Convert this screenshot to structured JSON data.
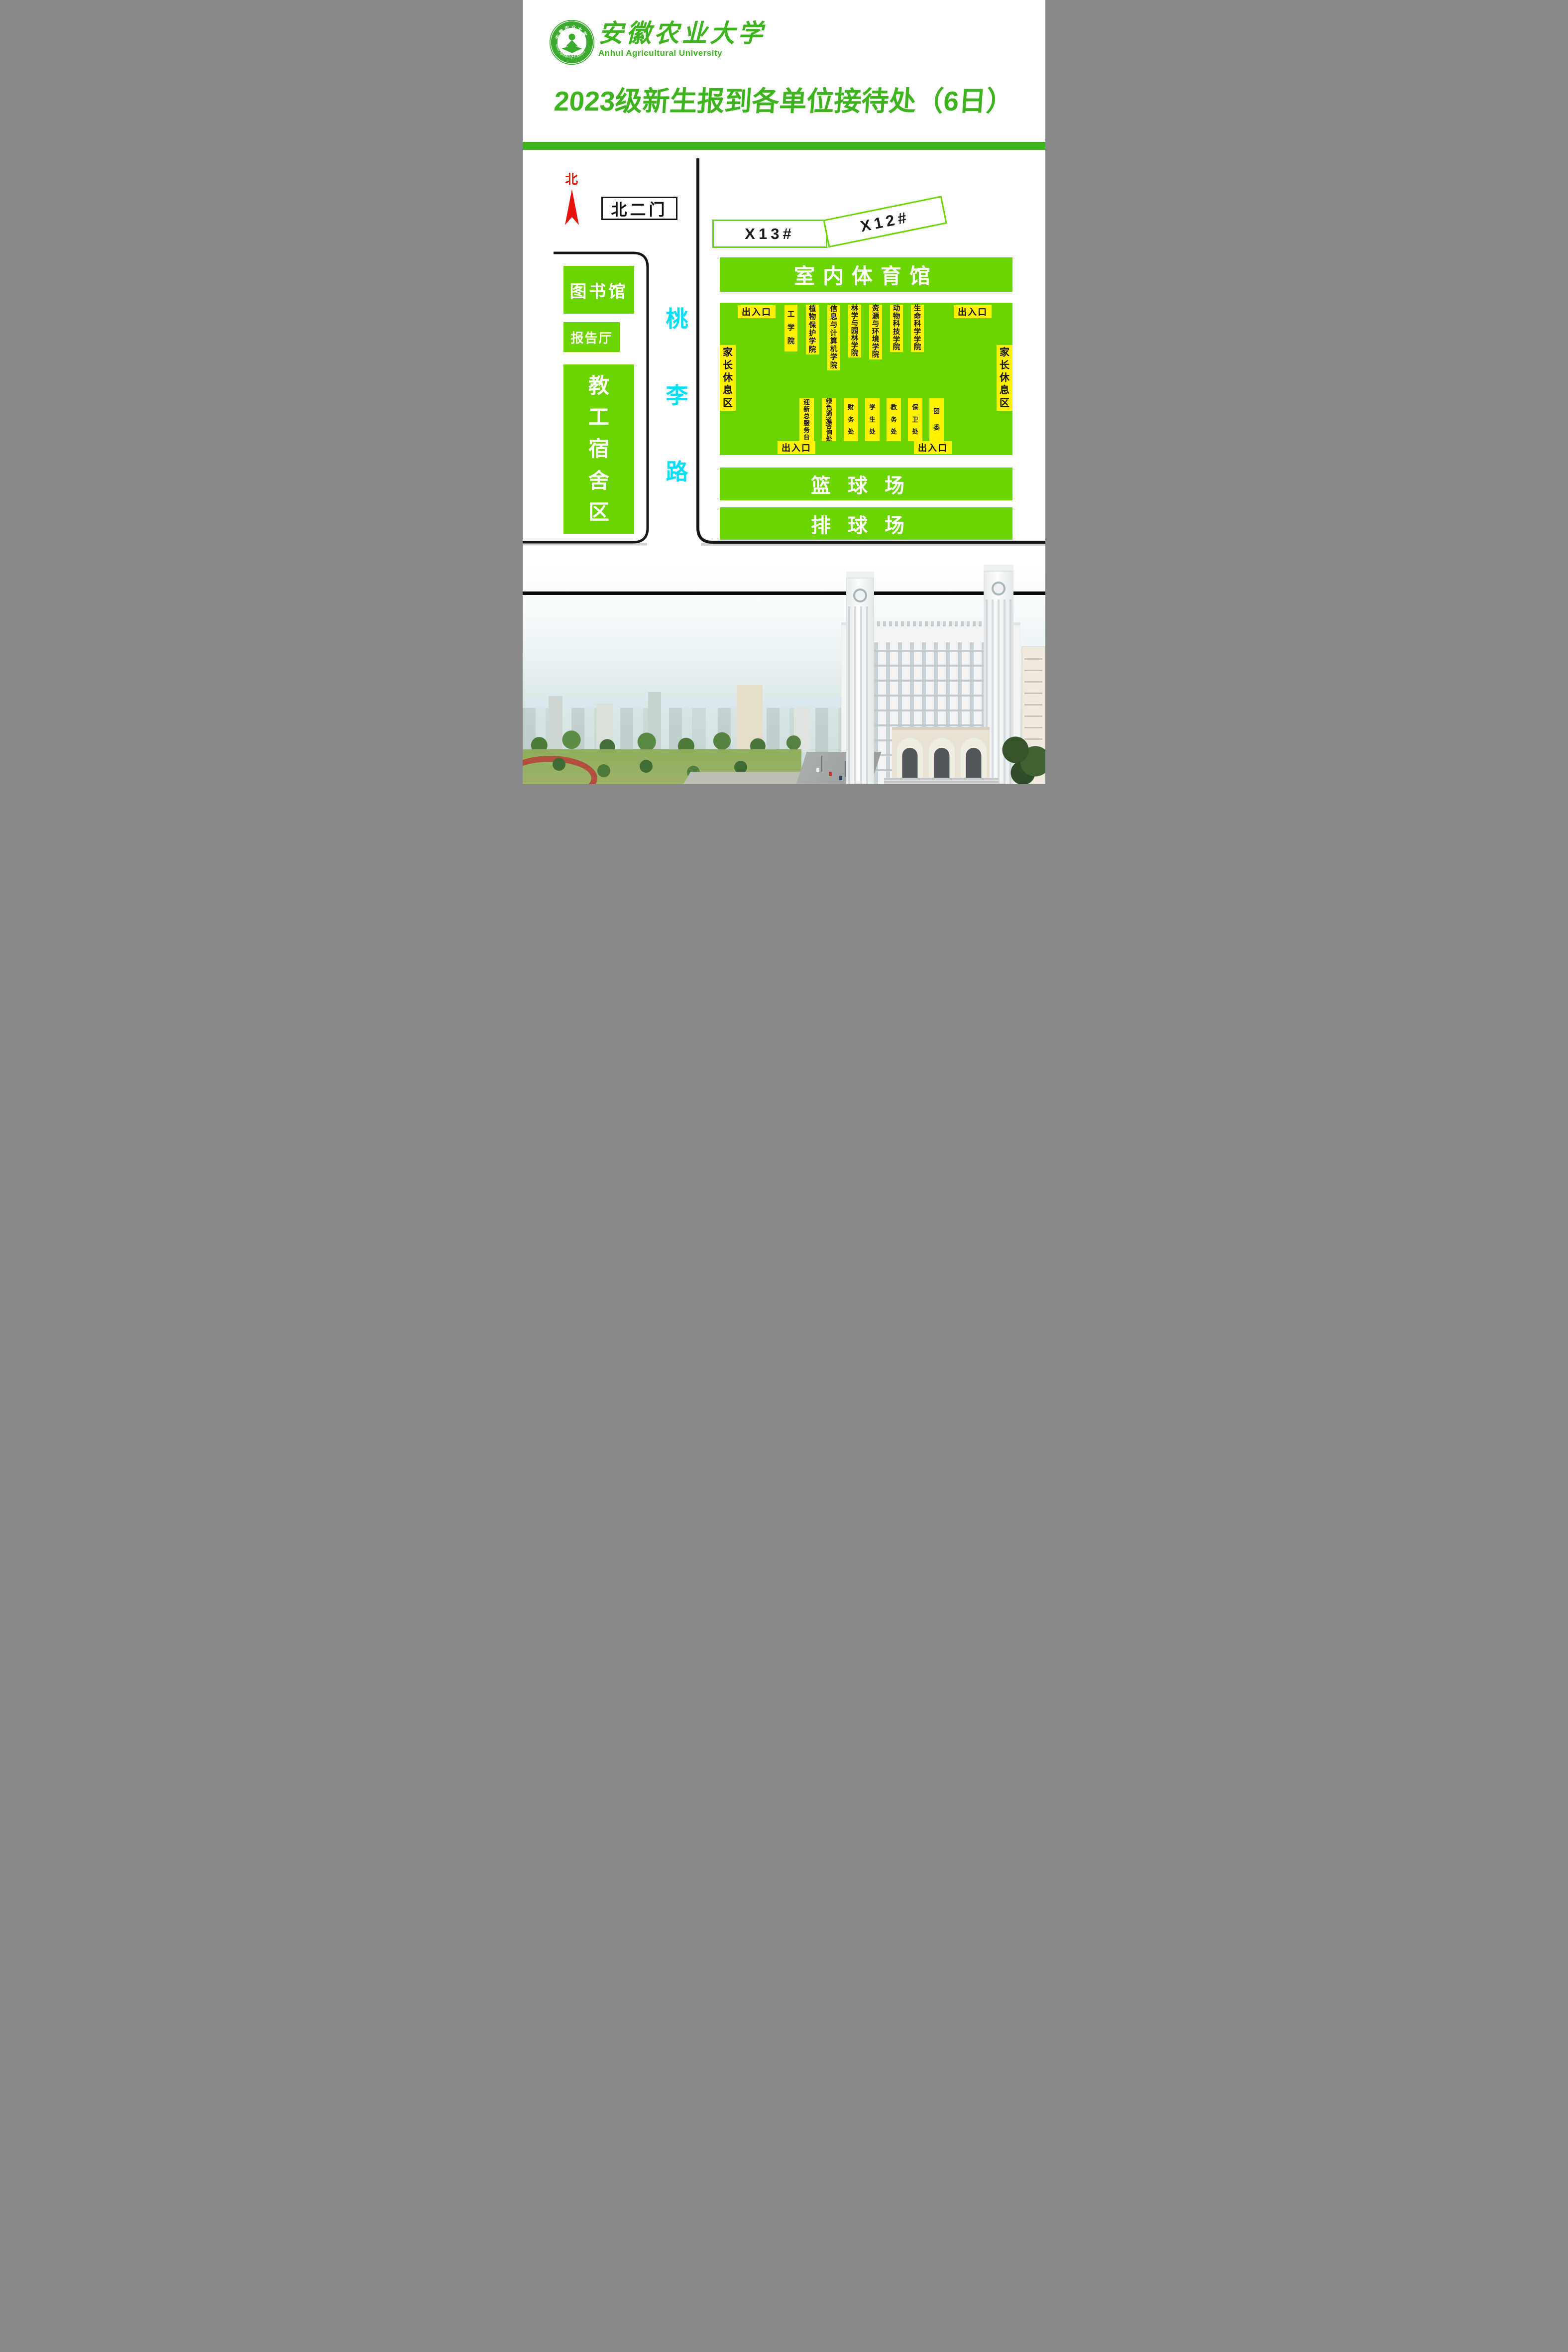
{
  "header": {
    "university_cn": "安徽农业大学",
    "university_en": "Anhui Agricultural University",
    "seal_year": "1928",
    "title": "2023级新生报到各单位接待处（6日）"
  },
  "compass": {
    "north_label": "北"
  },
  "map": {
    "gate_label": "北二门",
    "road_label": "桃李路",
    "library": "图书馆",
    "lecture_hall": "报告厅",
    "staff_dorm": "教工宿舍区",
    "dorm_x13": "X13#",
    "dorm_x12": "X12#",
    "gym": "室内体育馆",
    "basketball": "篮球场",
    "volleyball": "排球场",
    "entrance_label": "出入口",
    "parent_rest_label": "家长休息区",
    "colleges": [
      "工学院",
      "植物保护学院",
      "信息与计算机学院",
      "林学与园林学院",
      "资源与环境学院",
      "动物科技学院",
      "生命科学学院"
    ],
    "services": [
      "迎新总服务台",
      "绿色通道咨询处",
      "财务处",
      "学生处",
      "教务处",
      "保卫处",
      "团委"
    ]
  },
  "colors": {
    "themeGreen": "#3db41e",
    "mapGreen": "#6cd400",
    "labelYellow": "#fff100",
    "roadCyan": "#00dff7",
    "northRed": "#e8130c",
    "inkBlack": "#141414"
  }
}
